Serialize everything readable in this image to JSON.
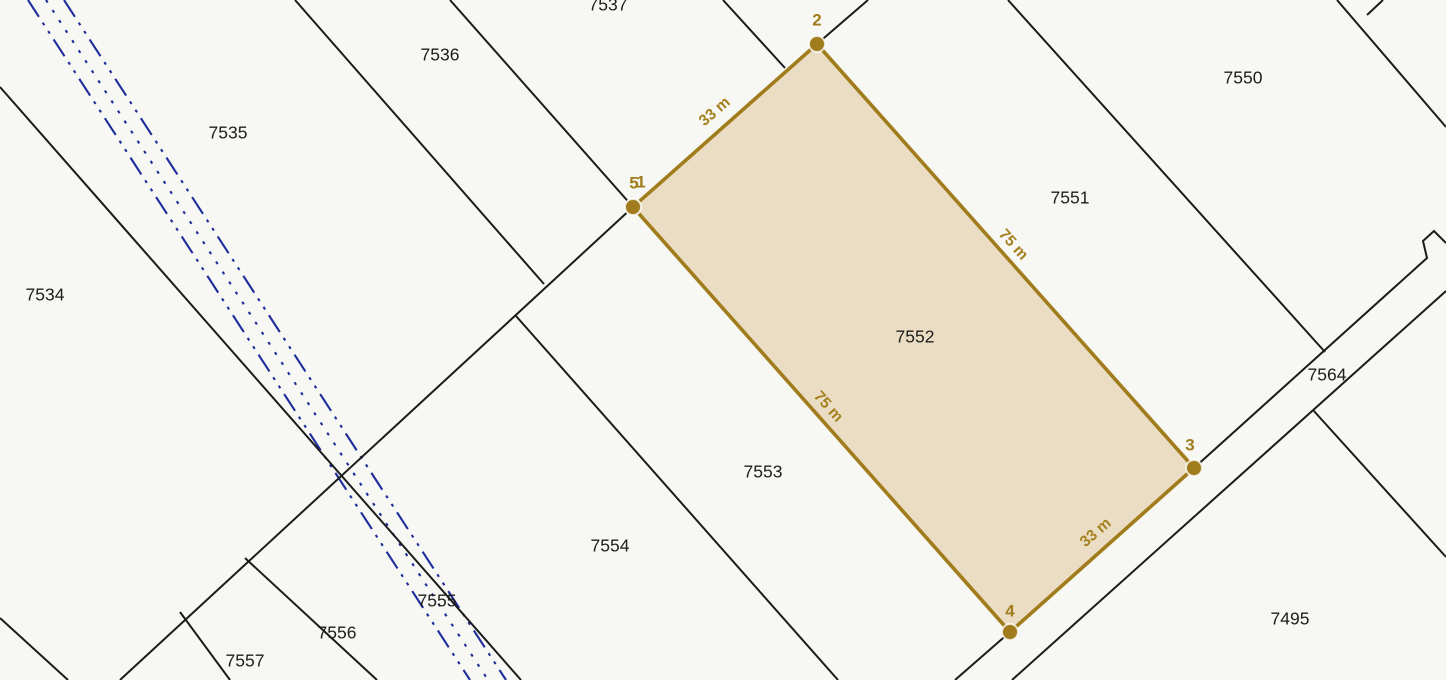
{
  "map": {
    "width": 1446,
    "height": 680,
    "colors": {
      "background": "#f7f7f4",
      "boundary_line": "#1b1b1b",
      "utility_line": "#1e2d9b",
      "highlight_stroke": "#a07c1c",
      "highlight_fill": "#eaddc3",
      "parcel_label": "#1d1d1d"
    },
    "parcel_labels": [
      {
        "text": "7534",
        "x": 45,
        "y": 296
      },
      {
        "text": "7535",
        "x": 228,
        "y": 134
      },
      {
        "text": "7536",
        "x": 440,
        "y": 56
      },
      {
        "text": "7537",
        "x": 608,
        "y": 6
      },
      {
        "text": "7550",
        "x": 1243,
        "y": 79
      },
      {
        "text": "7551",
        "x": 1070,
        "y": 199
      },
      {
        "text": "7553",
        "x": 763,
        "y": 473
      },
      {
        "text": "7554",
        "x": 610,
        "y": 547
      },
      {
        "text": "7555",
        "x": 437,
        "y": 602
      },
      {
        "text": "7556",
        "x": 337,
        "y": 634
      },
      {
        "text": "7557",
        "x": 245,
        "y": 662
      },
      {
        "text": "7564",
        "x": 1327,
        "y": 376
      },
      {
        "text": "7495",
        "x": 1290,
        "y": 620
      }
    ],
    "boundary_lines": [
      {
        "name": "strip-7534-7535",
        "points": [
          [
            0,
            87
          ],
          [
            521,
            680
          ]
        ]
      },
      {
        "name": "strip-7535-7536",
        "points": [
          [
            295,
            0
          ],
          [
            544,
            284
          ]
        ]
      },
      {
        "name": "strip-7536-7537",
        "points": [
          [
            450,
            0
          ],
          [
            633,
            207
          ]
        ]
      },
      {
        "name": "strip-7537-right",
        "points": [
          [
            723,
            0
          ],
          [
            785,
            68
          ]
        ]
      },
      {
        "name": "strip-7553-7554",
        "points": [
          [
            516,
            316
          ],
          [
            838,
            680
          ]
        ]
      },
      {
        "name": "strip-7555-7556",
        "points": [
          [
            245,
            558
          ],
          [
            377,
            680
          ]
        ]
      },
      {
        "name": "strip-7556-7557",
        "points": [
          [
            180,
            612
          ],
          [
            230,
            680
          ]
        ]
      },
      {
        "name": "strip-corner-bottom-left",
        "points": [
          [
            0,
            618
          ],
          [
            68,
            680
          ]
        ]
      },
      {
        "name": "strip-7550-7551",
        "points": [
          [
            1008,
            0
          ],
          [
            1325,
            352
          ]
        ]
      },
      {
        "name": "strip-top-right-corner",
        "points": [
          [
            1337,
            0
          ],
          [
            1446,
            127
          ]
        ]
      },
      {
        "name": "spur-top-right",
        "points": [
          [
            1367,
            15
          ],
          [
            1383,
            0
          ]
        ]
      },
      {
        "name": "strip-7495-right",
        "points": [
          [
            1313,
            410
          ],
          [
            1446,
            557
          ]
        ]
      },
      {
        "name": "cross-line-long",
        "points": [
          [
            633,
            207
          ],
          [
            120,
            680
          ]
        ]
      },
      {
        "name": "cross-line-vertex2",
        "points": [
          [
            817,
            44
          ],
          [
            868,
            0
          ]
        ]
      },
      {
        "name": "road-edge-upper",
        "points": [
          [
            955,
            680
          ],
          [
            1010,
            632
          ],
          [
            1194,
            468
          ],
          [
            1427,
            258
          ],
          [
            1423,
            241
          ],
          [
            1434,
            231
          ],
          [
            1446,
            243
          ]
        ]
      },
      {
        "name": "road-edge-lower",
        "points": [
          [
            1012,
            680
          ],
          [
            1446,
            291
          ]
        ]
      }
    ],
    "utility_lines": [
      {
        "name": "utility-dashdot-west",
        "dash": "dashdotdot",
        "points": [
          [
            28,
            0
          ],
          [
            470,
            680
          ]
        ]
      },
      {
        "name": "utility-dotted-mid",
        "dash": "dotted",
        "points": [
          [
            46,
            0
          ],
          [
            488,
            680
          ]
        ]
      },
      {
        "name": "utility-dashdot-east",
        "dash": "dashdotdot",
        "points": [
          [
            64,
            0
          ],
          [
            506,
            680
          ]
        ]
      }
    ],
    "highlight_parcel": {
      "label": "7552",
      "label_x": 915,
      "label_y": 338,
      "polygon": [
        [
          633,
          207
        ],
        [
          817,
          44
        ],
        [
          1194,
          468
        ],
        [
          1010,
          632
        ]
      ],
      "vertices": [
        {
          "label": "1",
          "x": 633,
          "y": 207,
          "dx": 8,
          "dy": -24
        },
        {
          "label": "2",
          "x": 817,
          "y": 44,
          "dx": 0,
          "dy": -23
        },
        {
          "label": "3",
          "x": 1194,
          "y": 468,
          "dx": -4,
          "dy": -22
        },
        {
          "label": "4",
          "x": 1010,
          "y": 632,
          "dx": 0,
          "dy": -20
        },
        {
          "label": "5",
          "x": 633,
          "y": 207,
          "dx": 1,
          "dy": -23
        }
      ],
      "edge_labels": [
        {
          "text": "33 m",
          "x": 715,
          "y": 112,
          "angle": -41
        },
        {
          "text": "75 m",
          "x": 1013,
          "y": 245,
          "angle": 48
        },
        {
          "text": "75 m",
          "x": 828,
          "y": 407,
          "angle": 48
        },
        {
          "text": "33 m",
          "x": 1096,
          "y": 533,
          "angle": -41
        }
      ]
    }
  }
}
